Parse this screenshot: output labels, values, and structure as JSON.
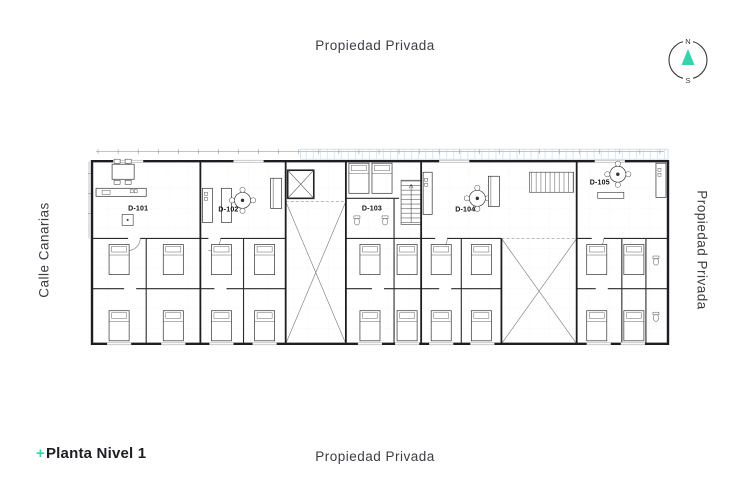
{
  "page": {
    "labels": {
      "top": "Propiedad Privada",
      "bottom": "Propiedad Privada",
      "right": "Propiedad Privada",
      "left": "Calle Canarias"
    },
    "plan_title": {
      "prefix": "+",
      "text": "Planta Nivel 1"
    }
  },
  "compass": {
    "north": "N",
    "south": "S"
  },
  "colors": {
    "accent": "#35d3ad",
    "ink": "#1e1e22",
    "label": "#3d3d44"
  },
  "plan": {
    "units": [
      {
        "id": "D-101",
        "x": 50,
        "y": 62
      },
      {
        "id": "D-102",
        "x": 140,
        "y": 63
      },
      {
        "id": "D-103",
        "x": 283,
        "y": 62
      },
      {
        "id": "D-104",
        "x": 376,
        "y": 63
      },
      {
        "id": "D-105",
        "x": 510,
        "y": 36
      }
    ]
  }
}
